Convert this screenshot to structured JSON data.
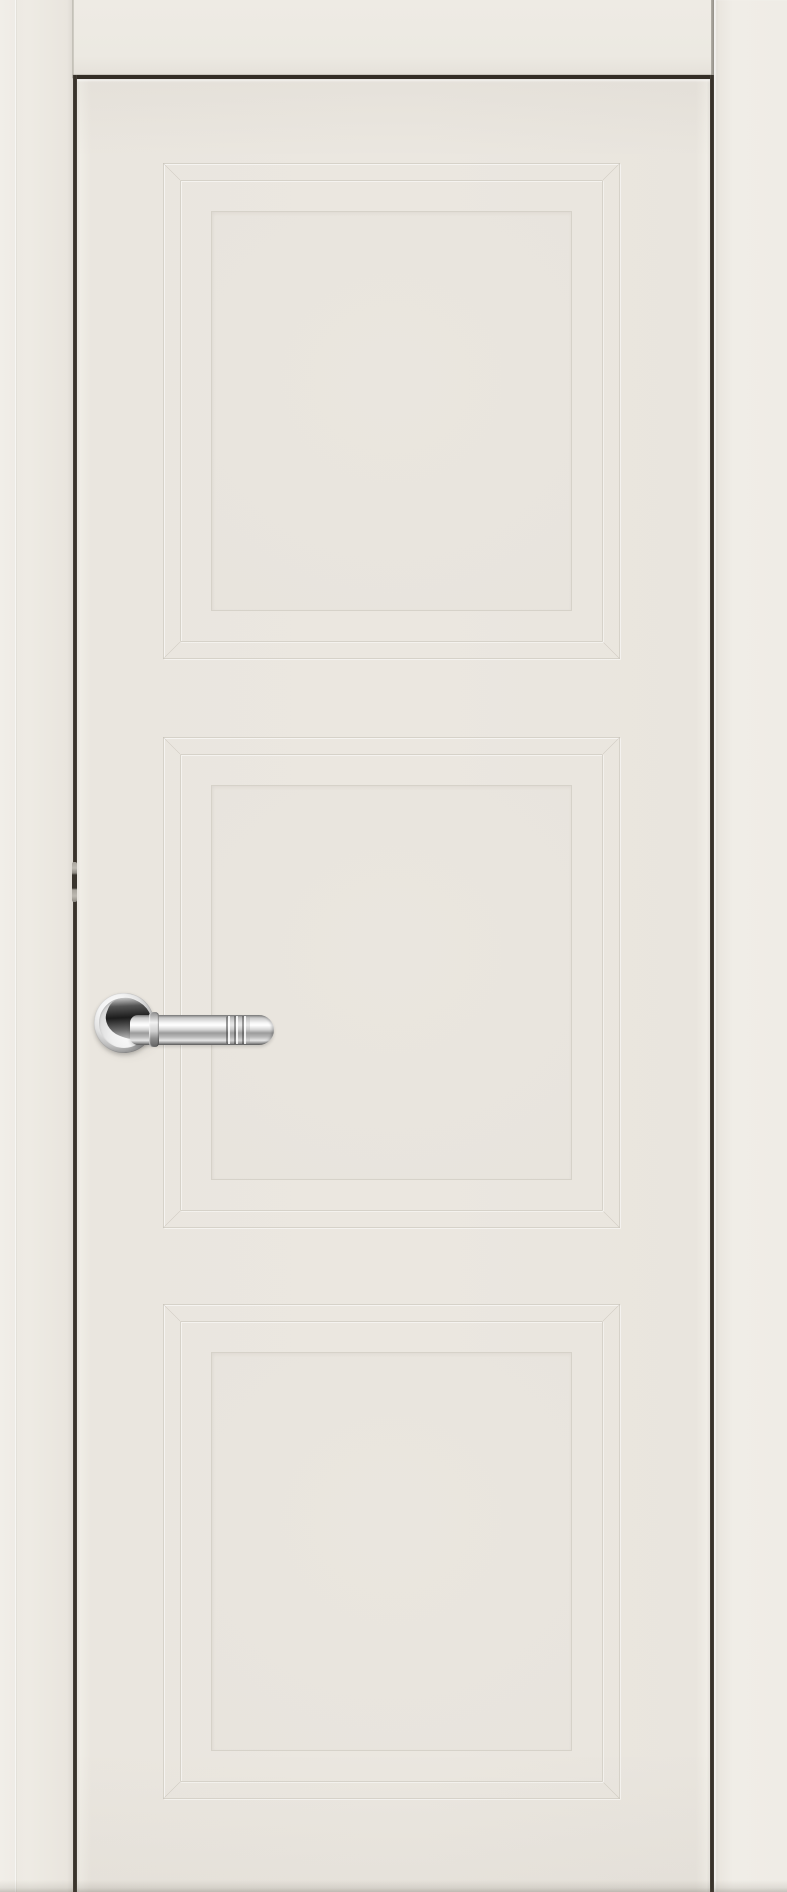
{
  "meta": {
    "type": "product-photo",
    "subject": "interior door, closed, front view"
  },
  "scene": {
    "description": "Product photograph of a closed cream-white (off-white enamel) interior door with three square recessed panels framed by stepped moldings, a polished chrome lever handle on a round rose mounted on the left stile, hung in a matching cream frame; dark clearance gaps outline the leaf and a hinge is visible in the left gap.",
    "door": {
      "finish": "matte cream / off-white enamel",
      "panel_count": 3,
      "panel_style": "square recessed panel with double stepped molding and mitred corners",
      "handle": {
        "type": "lever handle on round rose",
        "finish": "polished chrome",
        "side": "left stile",
        "details": "single collar ring near the rose, three decorative grooves near the rounded tip"
      },
      "hinge_visible": true
    },
    "colors": {
      "wall_bg": "#eeebe4",
      "casing": "#eeebe4",
      "casing_right": "#f0ede7",
      "door_face": "#ebe7e0",
      "panel_field": "#e8e4dd",
      "molding_line": "#d6d2c9",
      "molding_highlight": "#f4f1eb",
      "gap_dark": "#332d26",
      "hinge_metal": "#a9a59d",
      "chrome_light": "#fafafa",
      "chrome_mid": "#c9c9c9",
      "chrome_dark": "#6e6e6e",
      "neck_dark": "#1c1c1c"
    }
  }
}
